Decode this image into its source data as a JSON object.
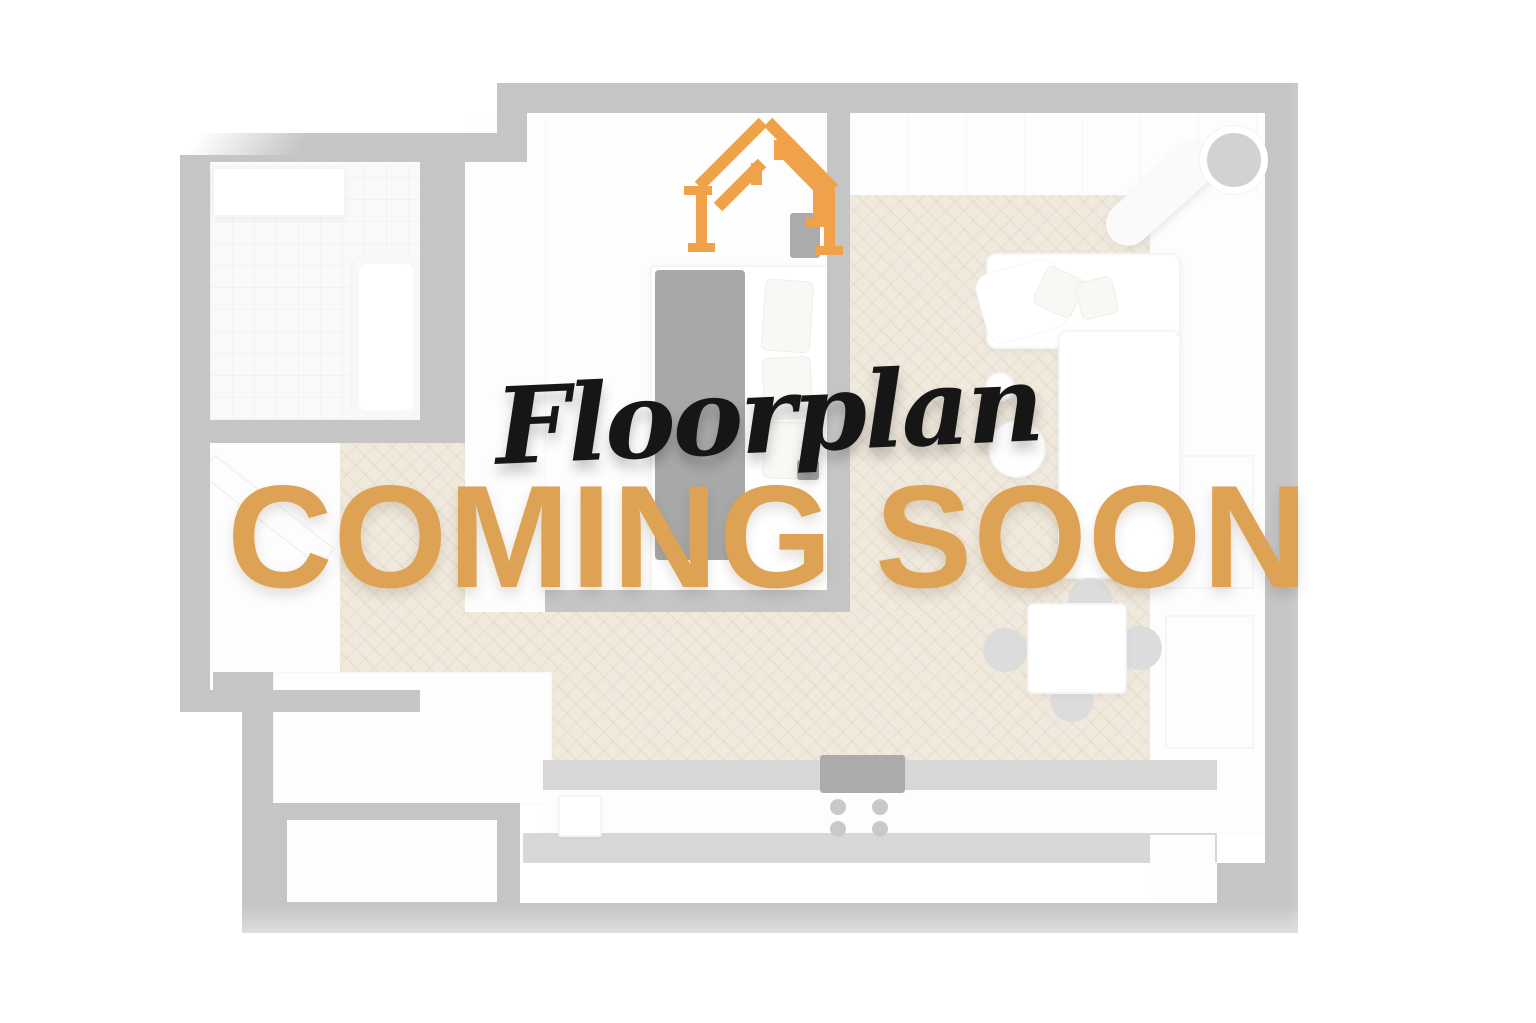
{
  "overlay": {
    "script_title": "Floorplan",
    "headline": "COMING SOON"
  },
  "colors": {
    "accent_orange": "#DDA253",
    "logo_orange": "#F0A24A",
    "script_black": "#161616",
    "wall_gray": "#7f7f7f",
    "floor_beige": "#ded0b6",
    "page_bg": "#ffffff"
  },
  "floorplan": {
    "opacity": 0.45,
    "description": "faded top-down apartment render"
  }
}
